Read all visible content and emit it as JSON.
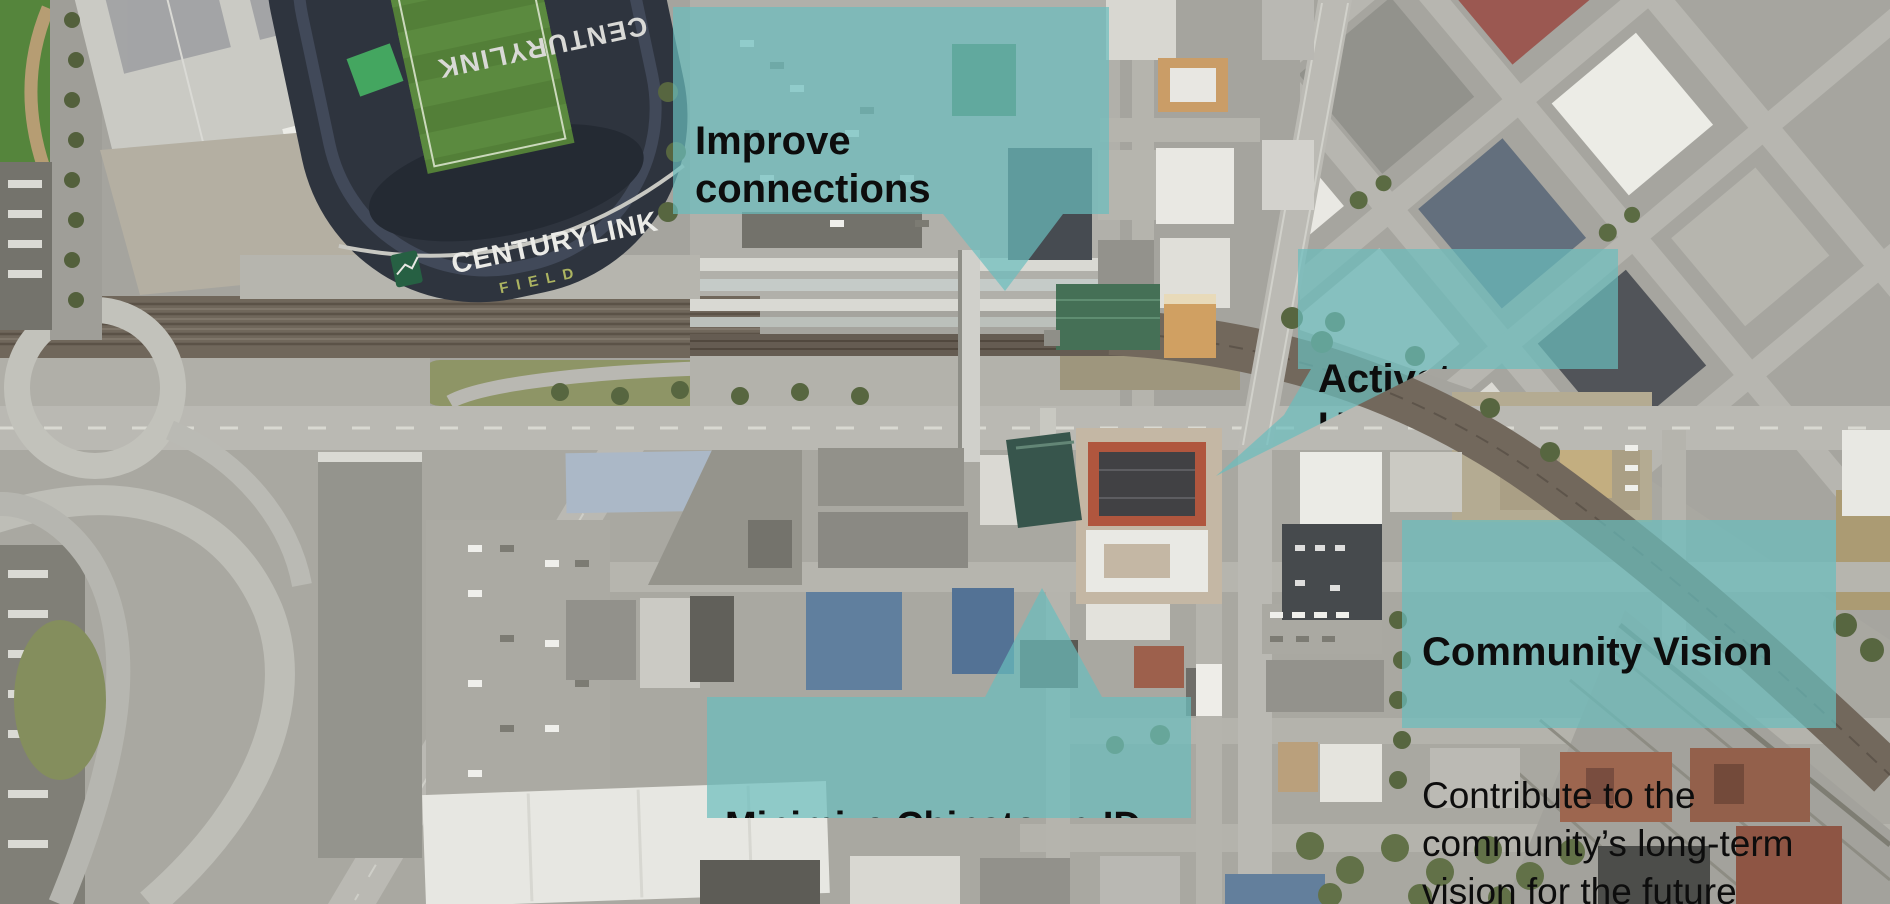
{
  "colors": {
    "callout_teal": "#69BEBE",
    "callout_teal_rgba": "rgba(105,190,190,0.7)",
    "callout_text": "#0d0d0d",
    "stadium_field_green": "#4d7a31",
    "stadium_roof_navy": "#262c38"
  },
  "map": {
    "stadium": {
      "name": "CENTURYLINK",
      "field_label": "FIELD",
      "north_name": "CENTURYLINK"
    }
  },
  "callouts": {
    "improve_connections": {
      "title": "Improve\nconnections",
      "body": "(Sounder, Amtrak, Light\nRail, Buses)"
    },
    "activate_union_station": {
      "title": "Activate\nUnion Station"
    },
    "community_vision": {
      "title": "Community Vision",
      "body": "Contribute to the\ncommunity’s long-term\nvision for the future"
    },
    "minimize_chinatown_id": {
      "title": "Minimize Chinatown-ID\nconstruction impacts"
    }
  }
}
